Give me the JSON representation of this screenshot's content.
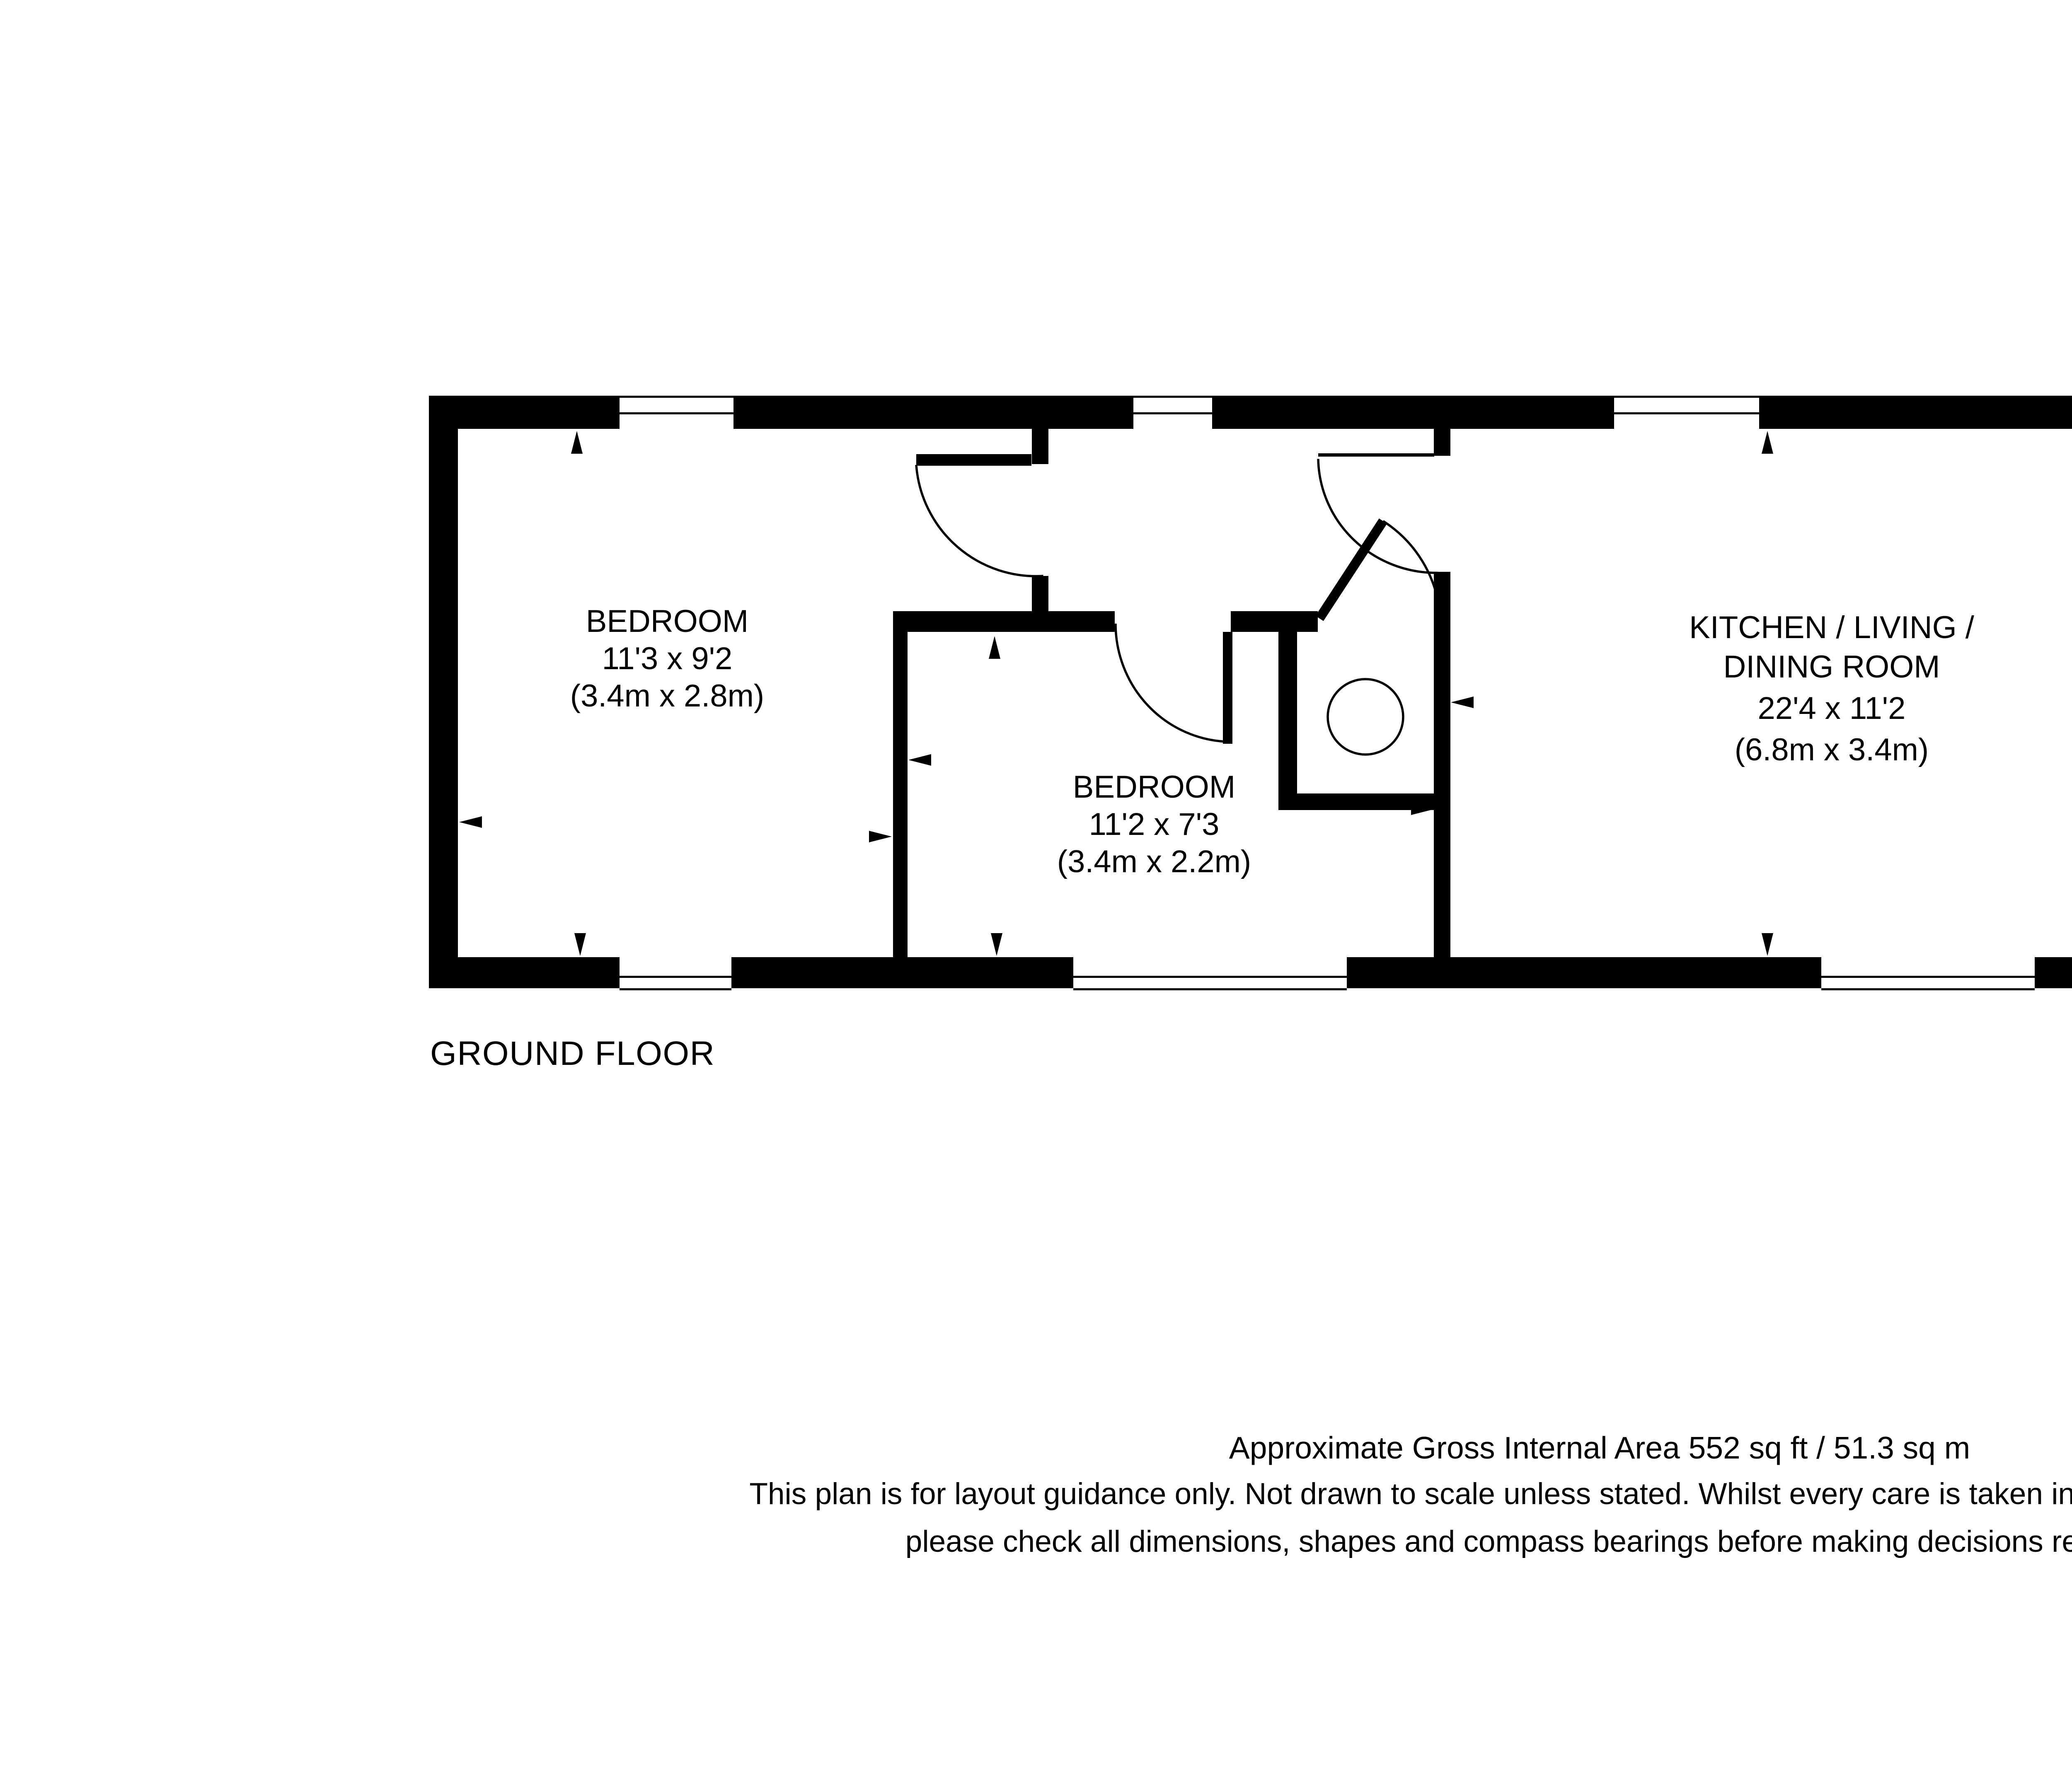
{
  "plan": {
    "floor_label": "GROUND FLOOR",
    "compass_label": "N",
    "rooms": {
      "bedroom1": {
        "name": "BEDROOM",
        "dims_imperial": "11'3 x 9'2",
        "dims_metric": "(3.4m x 2.8m)"
      },
      "bedroom2": {
        "name": "BEDROOM",
        "dims_imperial": "11'2 x 7'3",
        "dims_metric": "(3.4m x 2.2m)"
      },
      "kitchen": {
        "name_line1": "KITCHEN / LIVING /",
        "name_line2": "DINING ROOM",
        "dims_imperial": "22'4 x 11'2",
        "dims_metric": "(6.8m x 3.4m)"
      }
    },
    "icons": [
      "compass-rose-icon",
      "entrance-arrow-icon",
      "shower-tray-icon",
      "toilet-icon",
      "basin-icon",
      "kitchen-sink-icon",
      "hob-icon",
      "kitchen-counter",
      "cylinder-tank-icon",
      "door-swing-arc",
      "dimension-arrow"
    ],
    "colors": {
      "wall": "#000000",
      "background": "#ffffff",
      "line": "#000000"
    }
  },
  "footer": {
    "area_line": "Approximate Gross Internal Area 552 sq ft / 51.3 sq m",
    "disclaimer_line1": "This plan is for layout guidance only.  Not drawn to scale unless stated. Whilst every care is taken in the preparation of this plan,",
    "disclaimer_line2": "please check all dimensions, shapes and compass bearings before making decisions reliant upon them."
  }
}
